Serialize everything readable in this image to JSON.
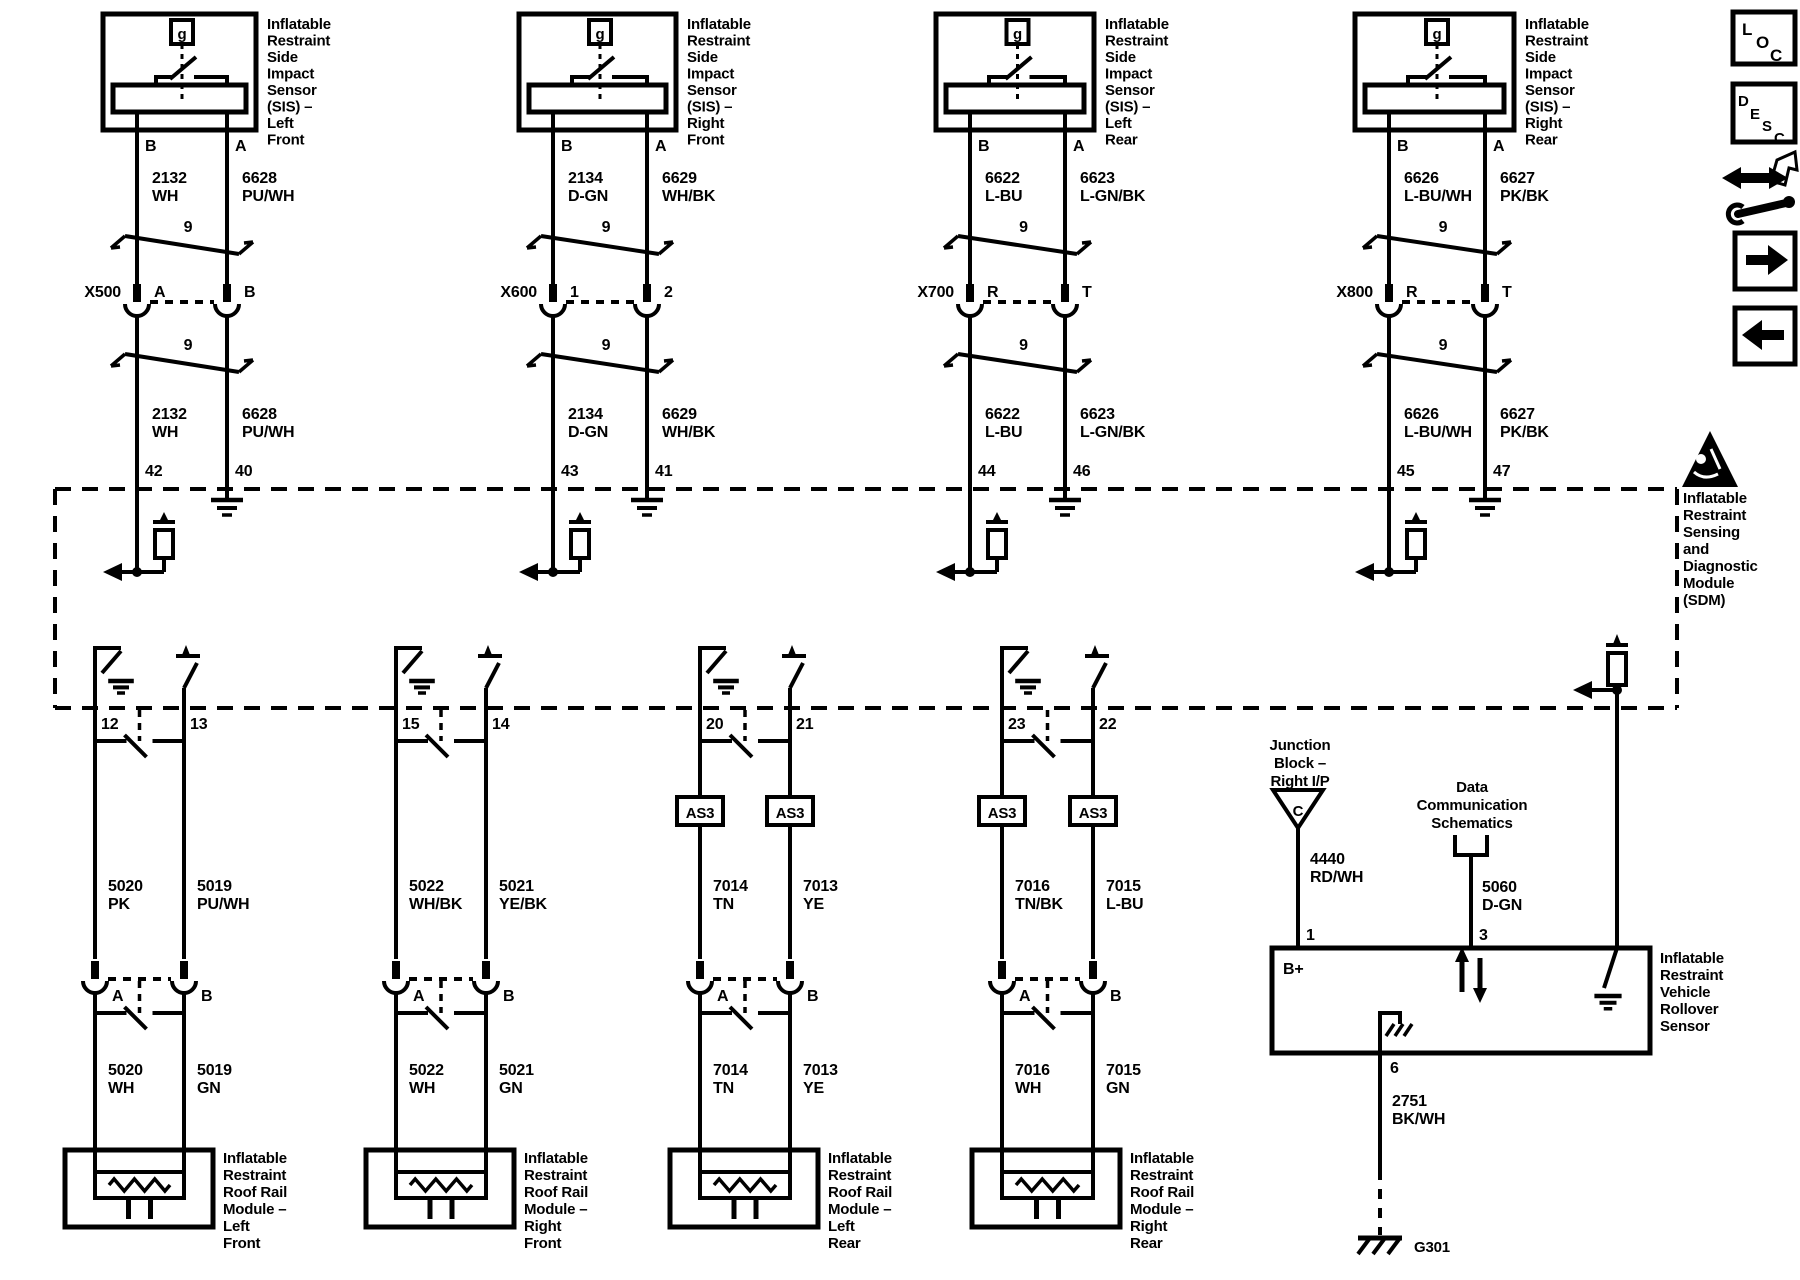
{
  "page": {
    "background": "#ffffff",
    "ink": "#000000"
  },
  "toolbar": {
    "loc_letters": [
      "L",
      "O",
      "C"
    ],
    "desc_letters": [
      "D",
      "E",
      "S",
      "C"
    ]
  },
  "sdm": {
    "label_lines": [
      "Inflatable",
      "Restraint",
      "Sensing",
      "and",
      "Diagnostic",
      "Module",
      "(SDM)"
    ],
    "pin58": "58"
  },
  "columns": [
    {
      "name": "left-front",
      "sensor_label_lines": [
        "Inflatable",
        "Restraint",
        "Side",
        "Impact",
        "Sensor",
        "(SIS) –",
        "Left",
        "Front"
      ],
      "sensor_switch_symbol": "g",
      "sensor_pins": [
        "B",
        "A"
      ],
      "pair_size": "9",
      "upper_wires": [
        {
          "id": "2132",
          "color": "WH"
        },
        {
          "id": "6628",
          "color": "PU/WH"
        }
      ],
      "connector": {
        "name": "X500",
        "pins": [
          "A",
          "B"
        ]
      },
      "sdm_pins": [
        "42",
        "40"
      ],
      "sdm_out_pins": [
        "12",
        "13"
      ],
      "has_as3": false,
      "as3_label": "AS3",
      "mid_wires": [
        {
          "id": "5020",
          "color": "PK"
        },
        {
          "id": "5019",
          "color": "PU/WH"
        }
      ],
      "mid_connector_pins": [
        "A",
        "B"
      ],
      "low_wires": [
        {
          "id": "5020",
          "color": "WH"
        },
        {
          "id": "5019",
          "color": "GN"
        }
      ],
      "module_label_lines": [
        "Inflatable",
        "Restraint",
        "Roof Rail",
        "Module –",
        "Left",
        "Front"
      ]
    },
    {
      "name": "right-front",
      "sensor_label_lines": [
        "Inflatable",
        "Restraint",
        "Side",
        "Impact",
        "Sensor",
        "(SIS) –",
        "Right",
        "Front"
      ],
      "sensor_switch_symbol": "g",
      "sensor_pins": [
        "B",
        "A"
      ],
      "pair_size": "9",
      "upper_wires": [
        {
          "id": "2134",
          "color": "D-GN"
        },
        {
          "id": "6629",
          "color": "WH/BK"
        }
      ],
      "connector": {
        "name": "X600",
        "pins": [
          "1",
          "2"
        ]
      },
      "sdm_pins": [
        "43",
        "41"
      ],
      "sdm_out_pins": [
        "15",
        "14"
      ],
      "has_as3": false,
      "as3_label": "AS3",
      "mid_wires": [
        {
          "id": "5022",
          "color": "WH/BK"
        },
        {
          "id": "5021",
          "color": "YE/BK"
        }
      ],
      "mid_connector_pins": [
        "A",
        "B"
      ],
      "low_wires": [
        {
          "id": "5022",
          "color": "WH"
        },
        {
          "id": "5021",
          "color": "GN"
        }
      ],
      "module_label_lines": [
        "Inflatable",
        "Restraint",
        "Roof Rail",
        "Module –",
        "Right",
        "Front"
      ]
    },
    {
      "name": "left-rear",
      "sensor_label_lines": [
        "Inflatable",
        "Restraint",
        "Side",
        "Impact",
        "Sensor",
        "(SIS) –",
        "Left",
        "Rear"
      ],
      "sensor_switch_symbol": "g",
      "sensor_pins": [
        "B",
        "A"
      ],
      "pair_size": "9",
      "upper_wires": [
        {
          "id": "6622",
          "color": "L-BU"
        },
        {
          "id": "6623",
          "color": "L-GN/BK"
        }
      ],
      "connector": {
        "name": "X700",
        "pins": [
          "R",
          "T"
        ]
      },
      "sdm_pins": [
        "44",
        "46"
      ],
      "sdm_out_pins": [
        "20",
        "21"
      ],
      "has_as3": true,
      "as3_label": "AS3",
      "mid_wires": [
        {
          "id": "7014",
          "color": "TN"
        },
        {
          "id": "7013",
          "color": "YE"
        }
      ],
      "mid_connector_pins": [
        "A",
        "B"
      ],
      "low_wires": [
        {
          "id": "7014",
          "color": "TN"
        },
        {
          "id": "7013",
          "color": "YE"
        }
      ],
      "module_label_lines": [
        "Inflatable",
        "Restraint",
        "Roof Rail",
        "Module –",
        "Left",
        "Rear"
      ]
    },
    {
      "name": "right-rear",
      "sensor_label_lines": [
        "Inflatable",
        "Restraint",
        "Side",
        "Impact",
        "Sensor",
        "(SIS) –",
        "Right",
        "Rear"
      ],
      "sensor_switch_symbol": "g",
      "sensor_pins": [
        "B",
        "A"
      ],
      "pair_size": "9",
      "upper_wires": [
        {
          "id": "6626",
          "color": "L-BU/WH"
        },
        {
          "id": "6627",
          "color": "PK/BK"
        }
      ],
      "connector": {
        "name": "X800",
        "pins": [
          "R",
          "T"
        ]
      },
      "sdm_pins": [
        "45",
        "47"
      ],
      "sdm_out_pins": [
        "23",
        "22"
      ],
      "has_as3": true,
      "as3_label": "AS3",
      "mid_wires": [
        {
          "id": "7016",
          "color": "TN/BK"
        },
        {
          "id": "7015",
          "color": "L-BU"
        }
      ],
      "mid_connector_pins": [
        "A",
        "B"
      ],
      "low_wires": [
        {
          "id": "7016",
          "color": "WH"
        },
        {
          "id": "7015",
          "color": "GN"
        }
      ],
      "module_label_lines": [
        "Inflatable",
        "Restraint",
        "Roof Rail",
        "Module –",
        "Right",
        "Rear"
      ]
    }
  ],
  "right_section": {
    "junction_block": {
      "label_lines": [
        "Junction",
        "Block –",
        "Right I/P"
      ],
      "terminal": "C",
      "wire": {
        "id": "4440",
        "color": "RD/WH"
      },
      "pin": "1",
      "inside_label": "B+"
    },
    "data_comm": {
      "label_lines": [
        "Data",
        "Communication",
        "Schematics"
      ],
      "wire": {
        "id": "5060",
        "color": "D-GN"
      },
      "pin": "3"
    },
    "sdm_output": {
      "pin": "58",
      "wire": {
        "id": "5229",
        "color": "YE/BK"
      },
      "pin_in": "5"
    },
    "rollover_sensor": {
      "label_lines": [
        "Inflatable",
        "Restraint",
        "Vehicle",
        "Rollover",
        "Sensor"
      ],
      "ground_pin": "6",
      "ground_wire": {
        "id": "2751",
        "color": "BK/WH"
      },
      "ground_name": "G301"
    }
  }
}
